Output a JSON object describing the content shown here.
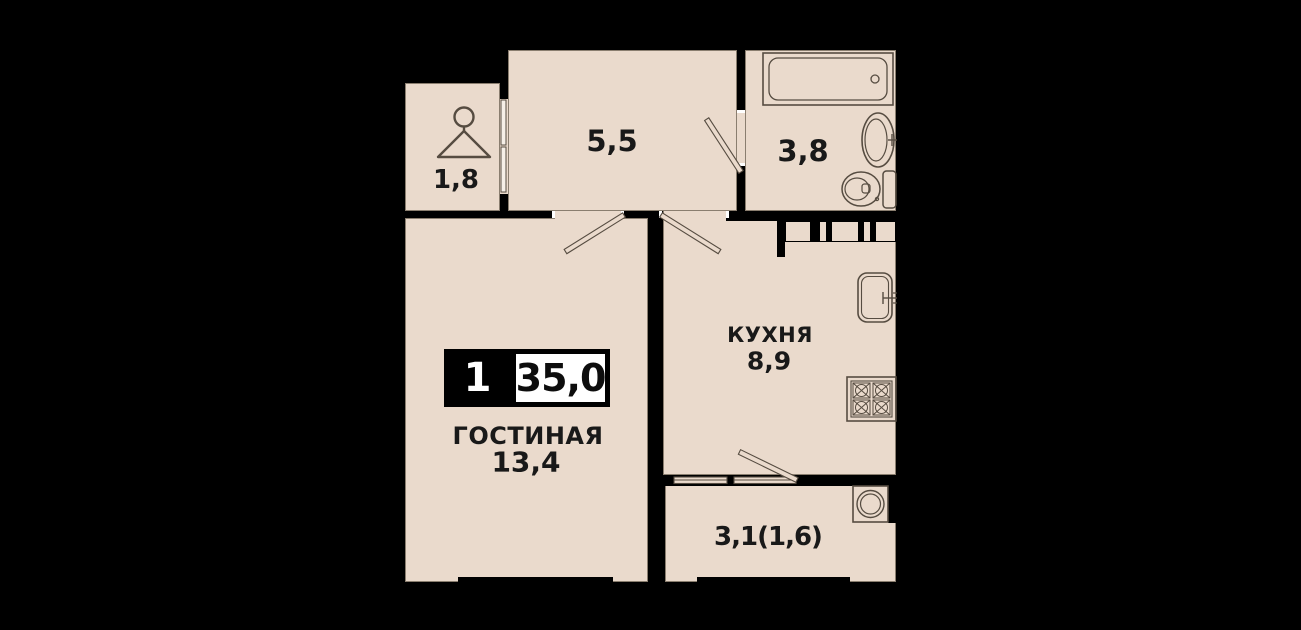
{
  "plan": {
    "badge": {
      "rooms_count": "1",
      "total_area": "35,0"
    },
    "rooms": {
      "closet": {
        "area": "1,8"
      },
      "hallway": {
        "area": "5,5"
      },
      "bathroom": {
        "area": "3,8"
      },
      "living": {
        "name": "ГОСТИНАЯ",
        "area": "13,4"
      },
      "kitchen": {
        "name": "КУХНЯ",
        "area": "8,9"
      },
      "balcony": {
        "area": "3,1(1,6)"
      }
    },
    "fixtures": [
      "hanger-icon",
      "bathtub",
      "bath-sink",
      "toilet",
      "kitchen-sink",
      "stove",
      "washing-machine"
    ],
    "colors": {
      "background": "#000000",
      "floor": "#eadacc",
      "outline": "#564c41",
      "badge_bg": "#000000",
      "badge_value_bg": "#ffffff",
      "text": "#191919"
    }
  }
}
